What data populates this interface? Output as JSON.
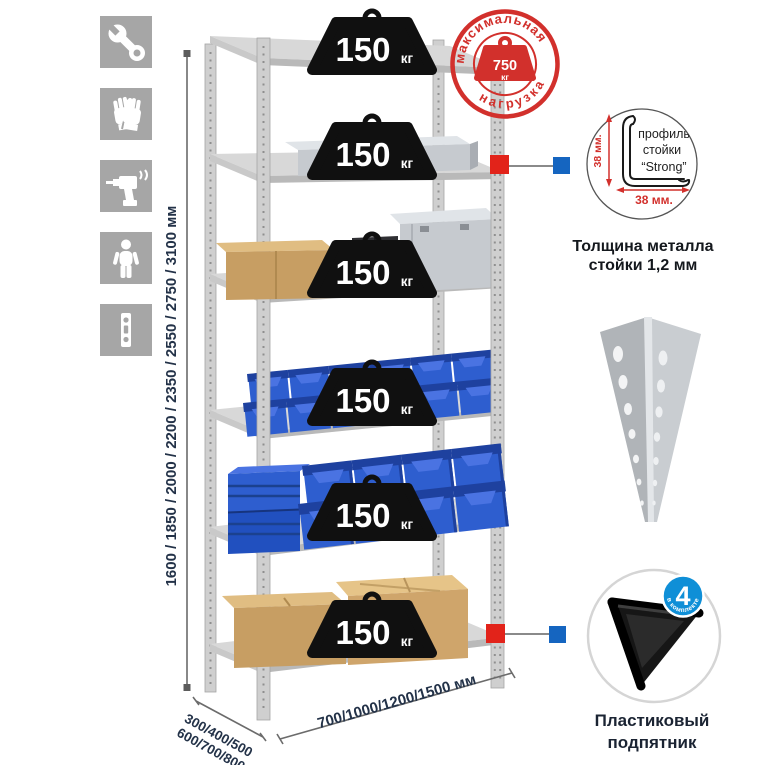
{
  "sidebar": {
    "icons": [
      {
        "name": "wrench"
      },
      {
        "name": "gloves"
      },
      {
        "name": "drill"
      },
      {
        "name": "person"
      },
      {
        "name": "rack-post-profile"
      }
    ]
  },
  "height_dimension": {
    "label": "1600 / 1850 / 2000 / 2200 / 2350 / 2550 / 2750 / 3100 мм"
  },
  "depth_dimension": {
    "line1": "300/400/500",
    "line2": "600/700/800 мм"
  },
  "width_dimension": {
    "label": "700/1000/1200/1500 мм"
  },
  "shelf_badges": [
    {
      "value": "150",
      "unit": "кг"
    },
    {
      "value": "150",
      "unit": "кг"
    },
    {
      "value": "150",
      "unit": "кг"
    },
    {
      "value": "150",
      "unit": "кг"
    },
    {
      "value": "150",
      "unit": "кг"
    },
    {
      "value": "150",
      "unit": "кг"
    }
  ],
  "max_load_stamp": {
    "arc_top": "максимальная",
    "arc_bottom": "нагрузка",
    "value": "750",
    "unit": "кг"
  },
  "profile_detail": {
    "label_line1": "профиль",
    "label_line2": "стойки",
    "label_line3": "“Strong”",
    "vertical_dim": "38 мм.",
    "horizontal_dim": "38 мм.",
    "caption_line1": "Толщина металла",
    "caption_line2": "стойки 1,2 мм"
  },
  "foot_detail": {
    "badge_count": "4",
    "badge_label": "в комплекте",
    "caption_line1": "Пластиковый",
    "caption_line2": "подпятник"
  },
  "colors": {
    "stamp_red": "#d2302c",
    "marker_red": "#e2231a",
    "marker_blue": "#1565c0",
    "badge_black": "#101010",
    "bin_blue": "#2e5ecf",
    "dim_text": "#233248",
    "icon_gray": "#a6a6a6",
    "accent_badge_blue": "#0f8fd7"
  }
}
